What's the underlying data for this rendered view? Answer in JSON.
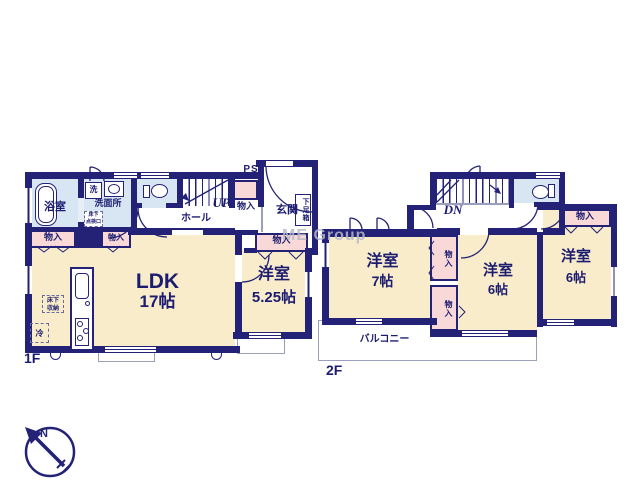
{
  "watermark": "ME Group",
  "compass": {
    "north": "N"
  },
  "f1": {
    "label": "1F",
    "bath": "浴室",
    "washer": "洗",
    "washroom": "洗面所",
    "inspection_hatch": {
      "l1": "床下",
      "l2": "点検口"
    },
    "hall": "ホール",
    "up": "UP",
    "ps": "PS",
    "closet_ps": "物入",
    "entrance": "玄関",
    "shoe_box": "下足箱",
    "closet_bath": "物入",
    "closet_wash": "物入",
    "closet_entrance": "物入",
    "ldk": "LDK",
    "ldk_size": "17帖",
    "underfloor_storage": {
      "l1": "床下",
      "l2": "収納"
    },
    "fridge": "冷",
    "room": "洋室",
    "room_size": "5.25帖"
  },
  "f2": {
    "label": "2F",
    "dn": "DN",
    "room7": "洋室",
    "room7_size": "7帖",
    "room6a": "洋室",
    "room6a_size": "6帖",
    "room6b": "洋室",
    "room6b_size": "6帖",
    "closet_a": "物入",
    "closet_b": "物入",
    "closet_c": "物入",
    "balcony": "バルコニー"
  }
}
